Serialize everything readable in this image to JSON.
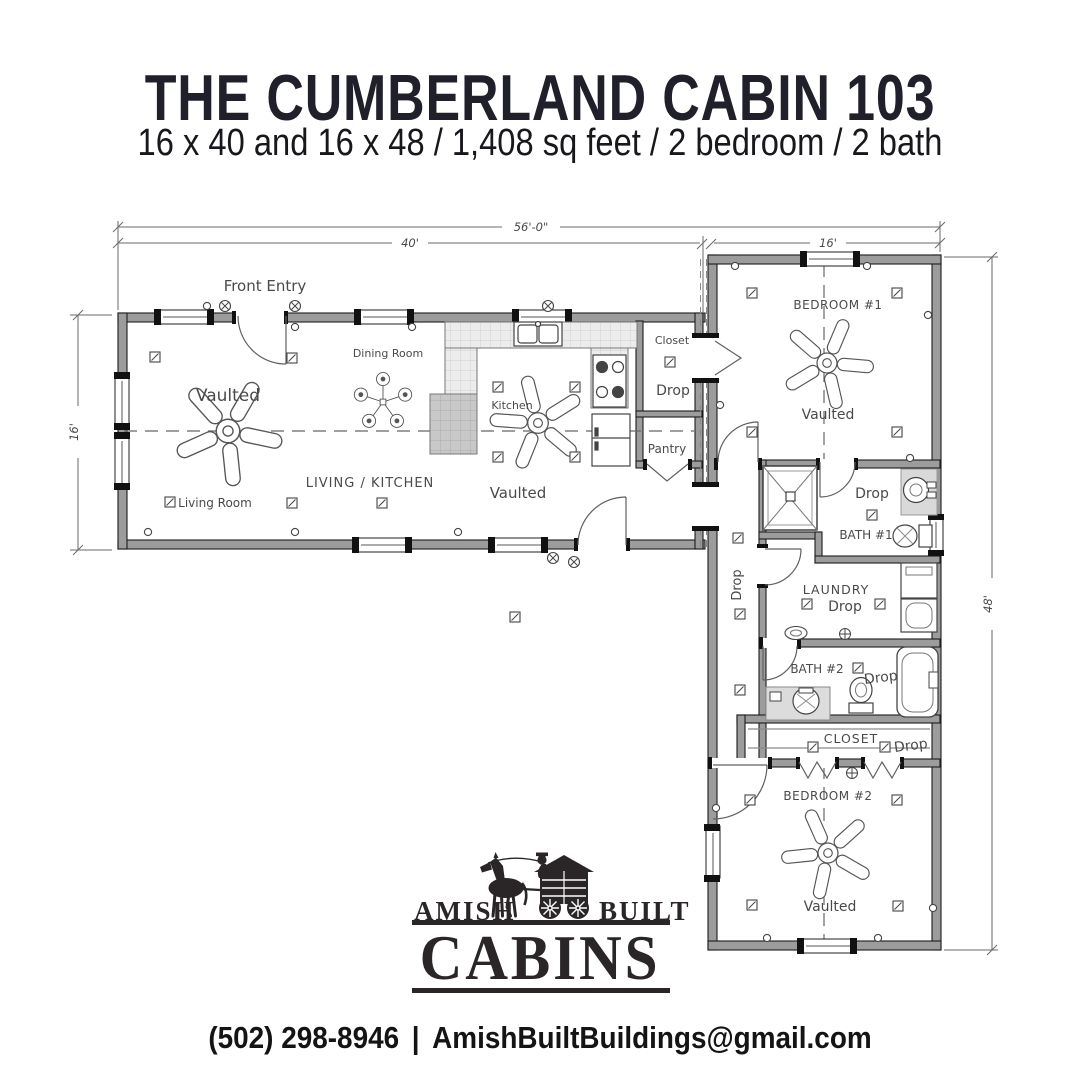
{
  "header": {
    "title": "THE CUMBERLAND CABIN 103",
    "subtitle": "16 x 40 and 16 x 48 / 1,408 sq feet / 2 bedroom / 2 bath"
  },
  "floorplan": {
    "dimensions": {
      "overall_width": "56'-0\"",
      "left_wing_width": "40'",
      "right_wing_width": "16'",
      "left_wing_depth": "16'",
      "right_wing_depth": "48'"
    },
    "labels": {
      "front_entry": "Front Entry",
      "dining_room": "Dining Room",
      "living_kitchen": "LIVING / KITCHEN",
      "living_room": "Living Room",
      "kitchen": "Kitchen",
      "closet": "Closet",
      "pantry": "Pantry",
      "bedroom1": "BEDROOM #1",
      "bath1": "BATH #1",
      "laundry": "LAUNDRY",
      "bath2": "BATH #2",
      "closet2": "CLOSET",
      "bedroom2": "BEDROOM #2",
      "vaulted": "Vaulted",
      "drop": "Drop"
    }
  },
  "logo": {
    "amish": "AMISH",
    "built": "BUILT",
    "cabins": "CABINS"
  },
  "footer": {
    "phone": "(502) 298-8946",
    "separator": "|",
    "email": "AmishBuiltBuildings@gmail.com"
  }
}
